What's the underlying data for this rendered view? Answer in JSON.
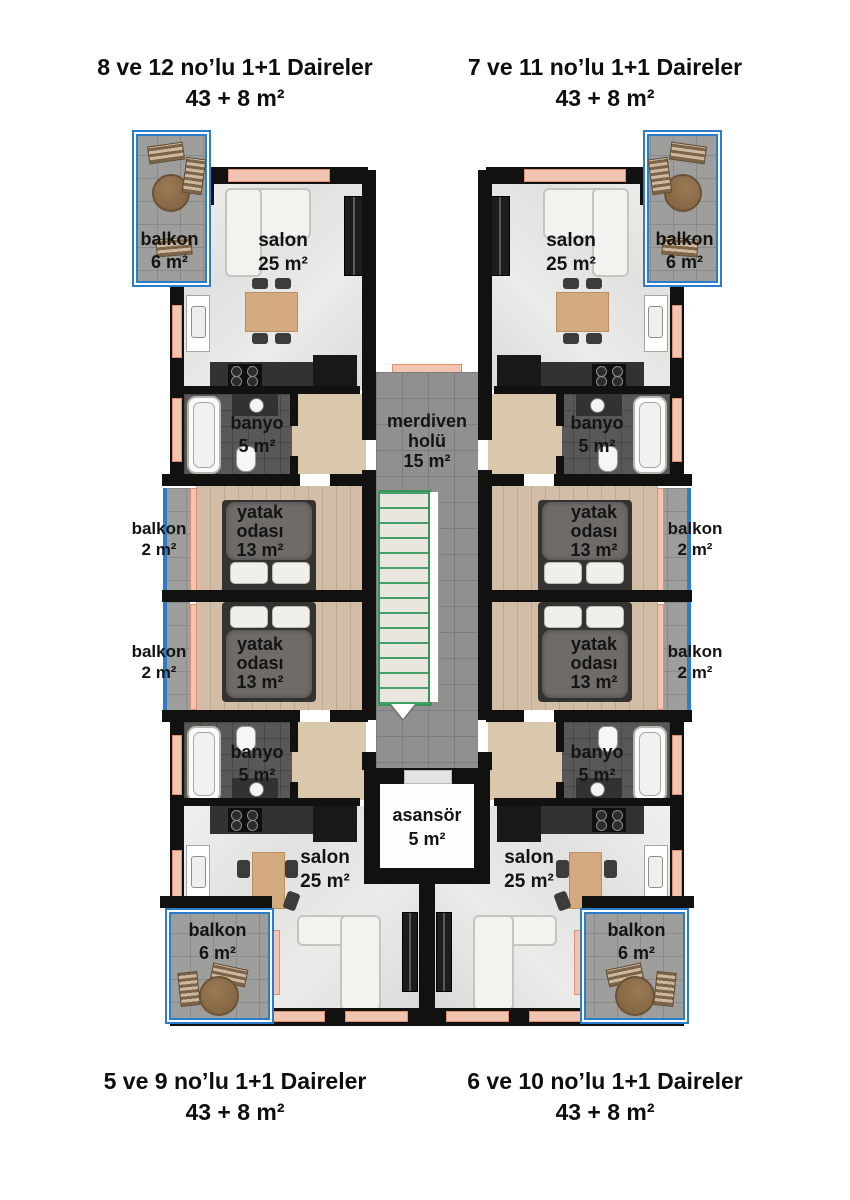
{
  "titles": {
    "top_left": {
      "line1": "8 ve 12 no’lu 1+1 Daireler",
      "line2": "43 + 8 m²"
    },
    "top_right": {
      "line1": "7 ve 11 no’lu 1+1 Daireler",
      "line2": "43 + 8 m²"
    },
    "bottom_left": {
      "line1": "5 ve 9 no’lu 1+1 Daireler",
      "line2": "43 + 8 m²"
    },
    "bottom_right": {
      "line1": "6 ve 10 no’lu 1+1 Daireler",
      "line2": "43 + 8 m²"
    }
  },
  "rooms": {
    "living": {
      "name": "salon",
      "area": "25 m²"
    },
    "bath": {
      "name": "banyo",
      "area": "5 m²"
    },
    "bedroom": {
      "line1": "yatak",
      "line2": "odası",
      "area": "13 m²"
    },
    "balcony_large": {
      "name": "balkon",
      "area": "6 m²"
    },
    "balcony_small": {
      "name": "balkon",
      "area": "2 m²"
    },
    "stair_hall": {
      "line1": "merdiven",
      "line2": "holü",
      "area": "15 m²"
    },
    "elevator": {
      "name": "asansör",
      "area": "5 m²"
    }
  },
  "colors": {
    "wall": "#111110",
    "balcony_rail_blue": "#2b7ccb",
    "window_salmon": "#f2c5b2",
    "stair_green": "#3c935c",
    "bath_tile": "#585856",
    "balcony_tile": "#9e9e9c",
    "hall_tile": "#909090",
    "wood_floor": "#d2bea7",
    "hall_beige": "#d9c8ab"
  }
}
